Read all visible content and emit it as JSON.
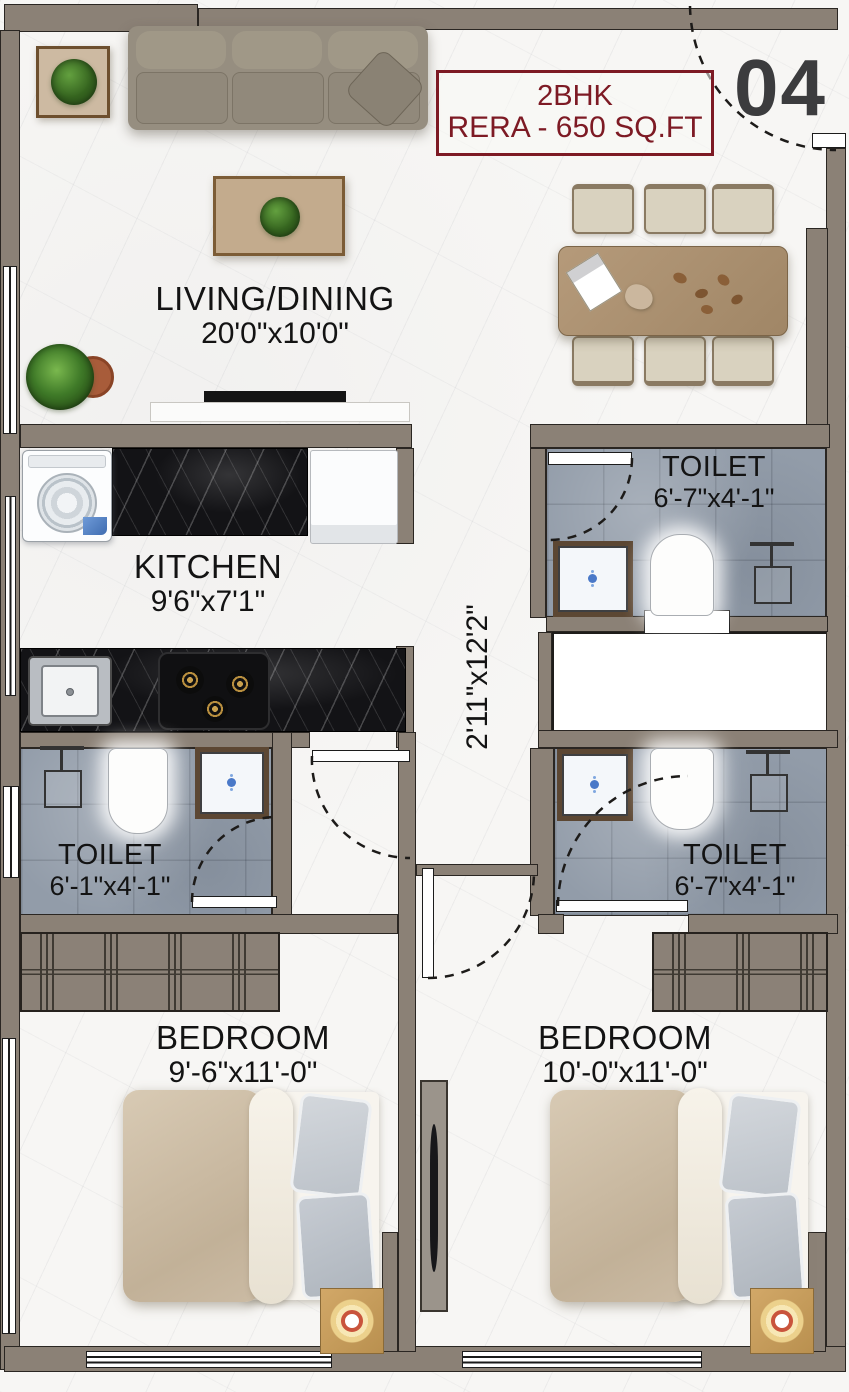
{
  "meta": {
    "unit_number": "04",
    "title_line1": "2BHK",
    "title_line2": "RERA - 650 SQ.FT"
  },
  "rooms": {
    "living": {
      "name": "LIVING/DINING",
      "dims": "20'0\"x10'0\""
    },
    "kitchen": {
      "name": "KITCHEN",
      "dims": "9'6\"x7'1\""
    },
    "toilet_top_right": {
      "name": "TOILET",
      "dims": "6'-7\"x4'-1\""
    },
    "toilet_left": {
      "name": "TOILET",
      "dims": "6'-1\"x4'-1\""
    },
    "toilet_mid_right": {
      "name": "TOILET",
      "dims": "6'-7\"x4'-1\""
    },
    "passage": {
      "dims": "2'11\"x12'2\""
    },
    "bedroom_left": {
      "name": "BEDROOM",
      "dims": "9'-6\"x11'-0\""
    },
    "bedroom_right": {
      "name": "BEDROOM",
      "dims": "10'-0\"x11'-0\""
    }
  },
  "colors": {
    "wall": "#8b8176",
    "floor_marble": "#f7f6f4",
    "toilet_floor": "#929ca9",
    "counter_black": "#131316",
    "accent_red": "#7d1a24",
    "unit_number_gray": "#3c3c3e",
    "wood": "#ab9179",
    "bed_duvet": "#cfc0a9"
  },
  "icons": {
    "sofa-icon": "css-shape",
    "potted-plant-icon": "css-shape",
    "dining-table-icon": "css-shape",
    "dining-chair-icon": "css-shape",
    "washing-machine-icon": "css-shape",
    "refrigerator-icon": "css-shape",
    "sink-icon": "css-shape",
    "stove-icon": "css-shape",
    "wc-icon": "css-shape",
    "wash-basin-icon": "css-shape",
    "shower-icon": "css-shape",
    "wardrobe-icon": "css-shape",
    "bed-icon": "css-shape",
    "nightstand-lamp-icon": "css-shape",
    "tv-unit-icon": "css-shape",
    "door-swing-arc": "svg-path",
    "window": "css-shape"
  }
}
